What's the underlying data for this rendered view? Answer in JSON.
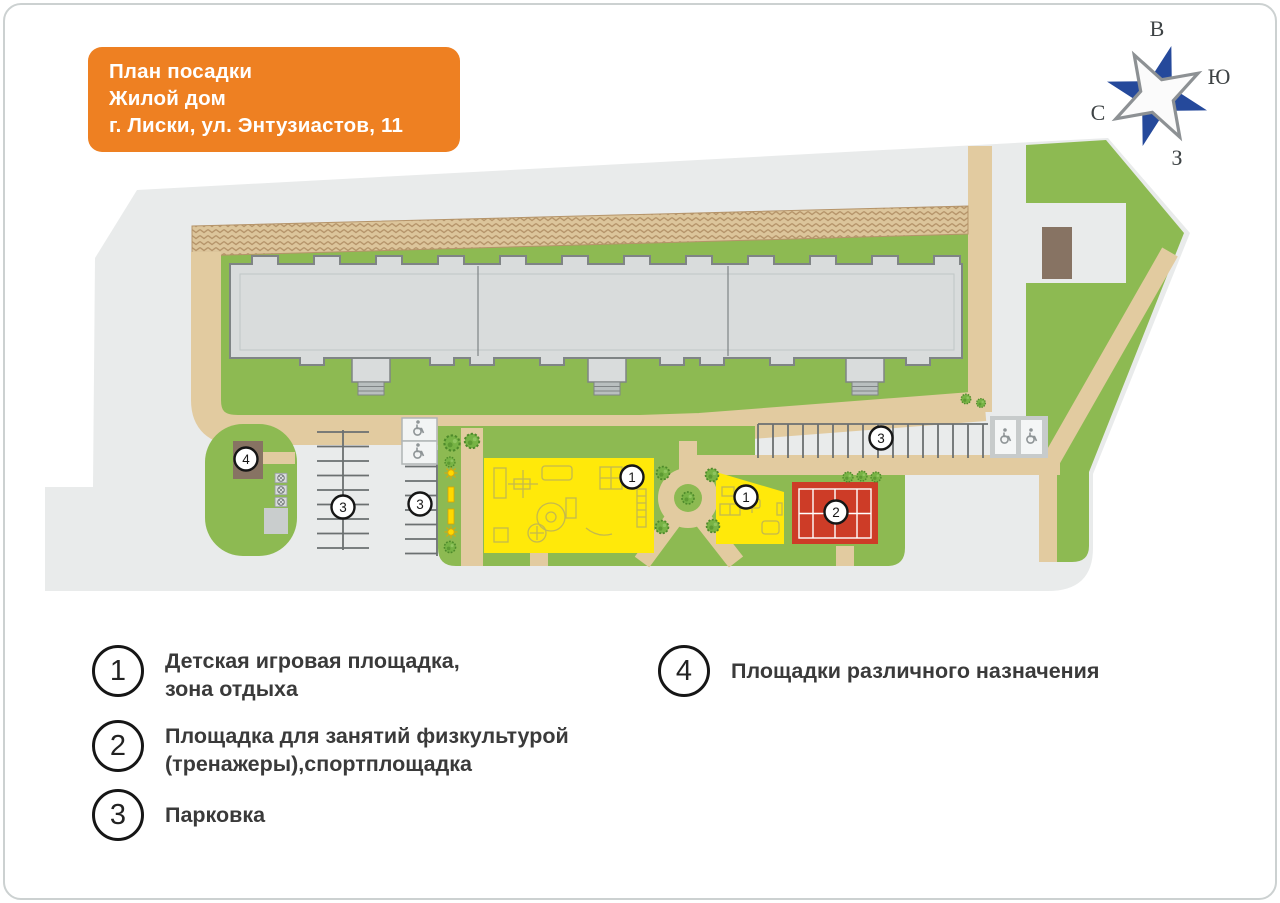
{
  "title": {
    "line1": "План посадки",
    "line2": "Жилой дом",
    "line3": "г. Лиски, ул. Энтузиастов, 11"
  },
  "compass": {
    "top": "В",
    "right": "Ю",
    "bottom": "З",
    "left": "С"
  },
  "legend": {
    "items": [
      {
        "num": "1",
        "line1": "Детская игровая площадка,",
        "line2": "зона отдыха"
      },
      {
        "num": "2",
        "line1": "Площадка для занятий физкультурой",
        "line2": "(тренажеры),спортплощадка"
      },
      {
        "num": "3",
        "line1": "Парковка",
        "line2": ""
      },
      {
        "num": "4",
        "line1": "Площадки различного назначения",
        "line2": ""
      }
    ]
  },
  "map": {
    "badges": [
      {
        "label": "1"
      },
      {
        "label": "1"
      },
      {
        "label": "2"
      },
      {
        "label": "3"
      },
      {
        "label": "3"
      },
      {
        "label": "3"
      },
      {
        "label": "4"
      }
    ]
  },
  "colors": {
    "orange": "#ee8022",
    "site_gray": "#e9ebeb",
    "green": "#8dba52",
    "path_tan": "#e2cba0",
    "hatch_bg": "#dcc59b",
    "hatch_line": "#b5946a",
    "building_fill": "#d9dcdc",
    "building_outline": "#7f8485",
    "playground_yellow": "#ffe90a",
    "equipment_line": "#c4b94e",
    "court_red": "#cd3c27",
    "structure_brown": "#877363",
    "compass_blue": "#25499b",
    "compass_gray": "#8d9194"
  }
}
